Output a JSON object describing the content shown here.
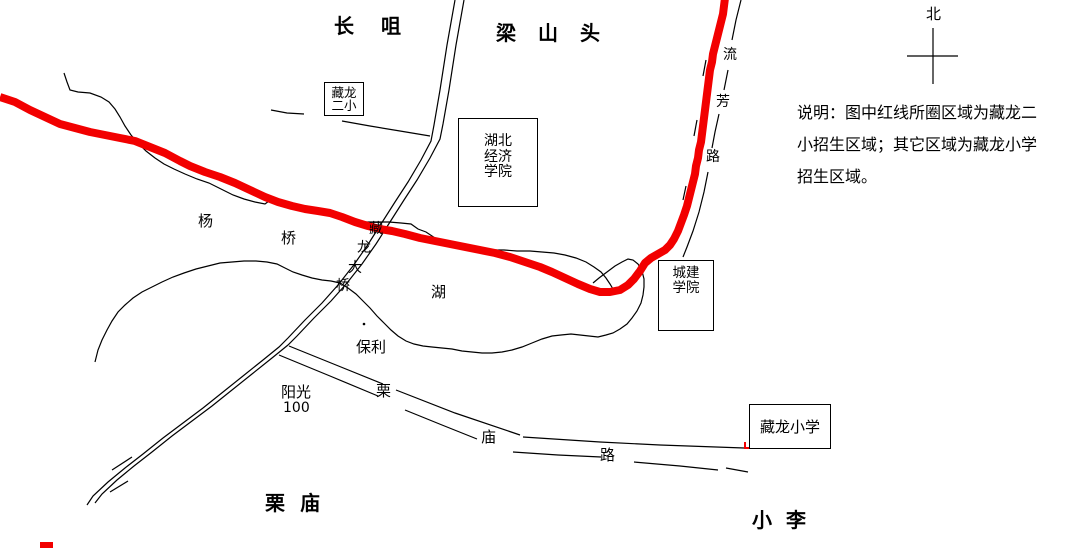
{
  "colors": {
    "boundary_red": "#f20000",
    "line_black": "#000000",
    "background": "#ffffff"
  },
  "labels": {
    "top_left_area": "长咀",
    "top_area": "梁山头",
    "yangqiao": {
      "yang": "杨",
      "qiao": "桥"
    },
    "bridge": {
      "c1": "藏",
      "c2": "龙",
      "c3": "大",
      "c4": "桥"
    },
    "lake": "湖",
    "baoli": "保利",
    "yangguang100": {
      "name": "阳光",
      "number": "100"
    },
    "limiao_road": {
      "c1": "栗",
      "c2": "庙",
      "c3": "路"
    },
    "liufang_road": {
      "c1": "流",
      "c2": "芳",
      "c3": "路"
    },
    "limiao_area": "栗庙",
    "xiaoli_area": "小李",
    "north": "北"
  },
  "boxes": {
    "zanglong_erxiao": {
      "line1": "藏龙",
      "line2": "二小"
    },
    "hubei_jingji_xueyuan": {
      "line1": "湖北",
      "line2": "经济",
      "line3": "学院"
    },
    "chengjian_xueyuan": {
      "line1": "城建",
      "line2": "学院"
    },
    "zanglong_xiaoxue": {
      "text": "藏龙小学"
    }
  },
  "note": {
    "line1": "说明：图中红线所圈区域为藏龙二",
    "line2": "小招生区域；其它区域为藏龙小学",
    "line3": "招生区域。"
  }
}
